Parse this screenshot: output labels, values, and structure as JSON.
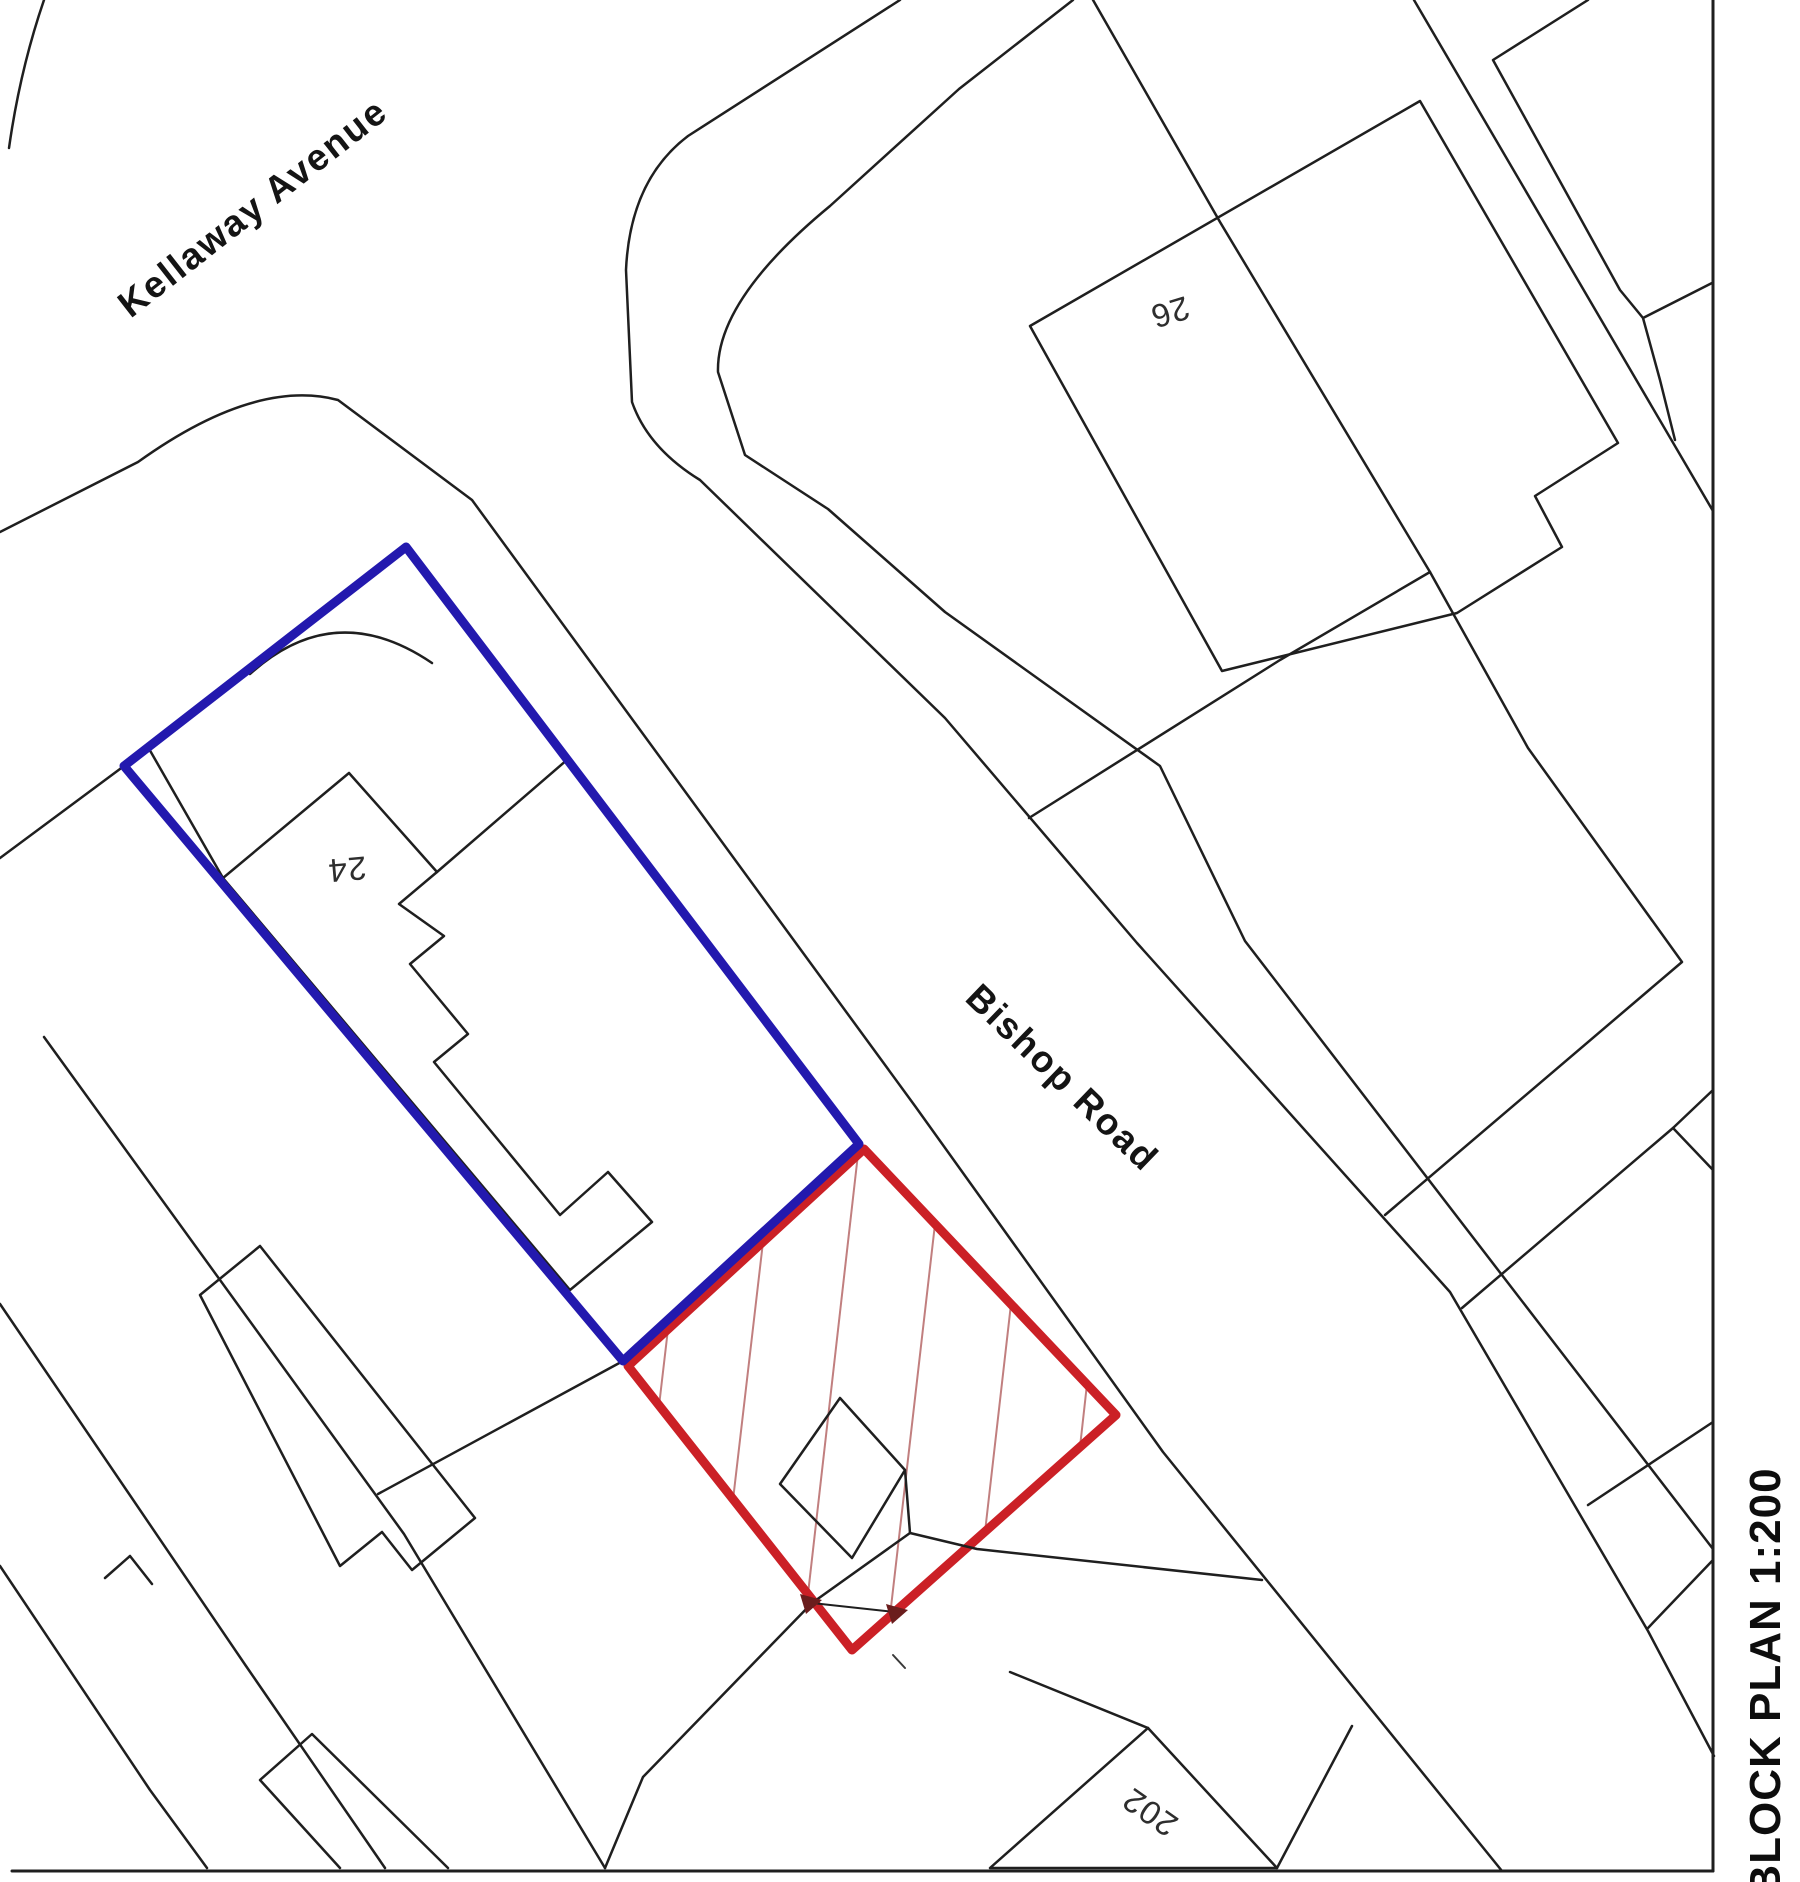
{
  "page": {
    "background": "#ffffff",
    "width": 1800,
    "height": 1882
  },
  "title": {
    "label": "BLOCK PLAN 1:200",
    "plan_type": "BLOCK PLAN",
    "scale": "1:200"
  },
  "streets": {
    "kellaway": {
      "name": "Kellaway Avenue"
    },
    "bishop": {
      "name": "Bishop Road"
    }
  },
  "plots": {
    "no26": {
      "number": "26"
    },
    "no24": {
      "number": "24"
    },
    "no202": {
      "number": "202"
    }
  },
  "legend": {
    "outlined_property_color": "#2319ae",
    "application_site_color": "#cb2026",
    "hatch_color": "#c17f7f",
    "line_color": "#1f1f1f"
  },
  "boundaries": {
    "blue_outline_vertices": "406,547 859,1144 623,1361 124,766",
    "red_site_vertices": "864,1149 1116,1415 852,1650 628,1366"
  },
  "map": {
    "paths": [
      {
        "name": "corner-arc-top-left",
        "d": "M44,0 Q20,70 9,148",
        "stroke": "#1f1f1f",
        "w": 2.5,
        "fill": "none"
      },
      {
        "name": "kerb-kellaway-bishop",
        "d": "M0,532 L138,462 Q255,378 338,400 L472,500 L915,1106 L1163,1452 L1502,1871",
        "stroke": "#1f1f1f",
        "w": 2.5,
        "fill": "none"
      },
      {
        "name": "road-ne-edge",
        "d": "M900,0 L688,136 Q630,180 626,270 L632,402 Q648,448 700,480 L945,718 L1137,943 L1450,1292 L1648,1631 L1714,1756",
        "stroke": "#1f1f1f",
        "w": 2.5,
        "fill": "none"
      },
      {
        "name": "corner-plot-inner-line",
        "d": "M1073,0 L959,89 L830,206 Q716,300 718,372 L745,455 L828,509 L945,612 L1160,766 L1245,941 L1545,1331 L1713,1549",
        "stroke": "#1f1f1f",
        "w": 2.5,
        "fill": "none"
      },
      {
        "name": "plot-boundary-line-a",
        "d": "M1093,0 L1220,222 L1430,572 L1528,748 L1682,962 L1385,1215",
        "stroke": "#1f1f1f",
        "w": 2.5,
        "fill": "none"
      },
      {
        "name": "plot-boundary-line-a-branch",
        "d": "M1430,572 L1280,660 L1029,818",
        "stroke": "#1f1f1f",
        "w": 2.5,
        "fill": "none"
      },
      {
        "name": "building-26-outline",
        "d": "M1420,101 L1030,326 L1222,671 L1457,613 L1562,547 L1535,496 L1618,443 Z",
        "stroke": "#1f1f1f",
        "w": 2.5,
        "fill": "none"
      },
      {
        "name": "plot-boundary-ne-parallel",
        "d": "M1414,0 L1713,511",
        "stroke": "#1f1f1f",
        "w": 2.5,
        "fill": "none"
      },
      {
        "name": "building-top-right-outline",
        "d": "M1588,0 L1493,60 L1620,290 L1643,318 M1643,318 L1712,283 M1643,318 L1660,380 L1675,440",
        "stroke": "#1f1f1f",
        "w": 2.5,
        "fill": "none"
      },
      {
        "name": "frame-border-right",
        "d": "M1713,0 L1713,1871",
        "stroke": "#1f1f1f",
        "w": 3,
        "fill": "none"
      },
      {
        "name": "frame-border-bottom",
        "d": "M12,1871 L1713,1871",
        "stroke": "#1f1f1f",
        "w": 3,
        "fill": "none"
      },
      {
        "name": "plot-boundary-east-1",
        "d": "M1713,1090 L1673,1128 L1462,1308",
        "stroke": "#1f1f1f",
        "w": 2.5,
        "fill": "none"
      },
      {
        "name": "plot-boundary-east-2",
        "d": "M1673,1128 L1713,1170",
        "stroke": "#1f1f1f",
        "w": 2.5,
        "fill": "none"
      },
      {
        "name": "plot-boundary-east-3",
        "d": "M1588,1505 L1713,1422",
        "stroke": "#1f1f1f",
        "w": 2.5,
        "fill": "none"
      },
      {
        "name": "plot-boundary-east-4",
        "d": "M1648,1628 L1713,1560",
        "stroke": "#1f1f1f",
        "w": 2.5,
        "fill": "none"
      },
      {
        "name": "blue-nw-edge-extension",
        "d": "M124,766 L0,858",
        "stroke": "#1f1f1f",
        "w": 2.5,
        "fill": "none"
      },
      {
        "name": "fence-sw-24",
        "d": "M148,747 L223,878",
        "stroke": "#1f1f1f",
        "w": 2.5,
        "fill": "none"
      },
      {
        "name": "fence-ne-24",
        "d": "M437,872 L568,759",
        "stroke": "#1f1f1f",
        "w": 2.5,
        "fill": "none"
      },
      {
        "name": "garden-arc-24",
        "d": "M250,674 Q335,597 432,663",
        "stroke": "#1f1f1f",
        "w": 2.5,
        "fill": "none"
      },
      {
        "name": "building-24-outline",
        "d": "M223,878 L349,773 L437,872 L399,904 L444,936 L410,964 L468,1034 L434,1062 L560,1215 L608,1172 L652,1222 L570,1290 Z",
        "stroke": "#1f1f1f",
        "w": 2.5,
        "fill": "none"
      },
      {
        "name": "plot-line-south-of-blue",
        "d": "M623,1361 L378,1494",
        "stroke": "#1f1f1f",
        "w": 2.5,
        "fill": "none"
      },
      {
        "name": "terrace-boundary-1",
        "d": "M44,1037 L404,1534 L605,1868",
        "stroke": "#1f1f1f",
        "w": 2.5,
        "fill": "none"
      },
      {
        "name": "terrace-boundary-2",
        "d": "M0,1304 L246,1666 L385,1868",
        "stroke": "#1f1f1f",
        "w": 2.5,
        "fill": "none"
      },
      {
        "name": "terrace-boundary-3",
        "d": "M0,1566 L150,1790 L207,1868",
        "stroke": "#1f1f1f",
        "w": 2.5,
        "fill": "none"
      },
      {
        "name": "terrace-building-1",
        "d": "M200,1295 L260,1246 L475,1518 L412,1570 L382,1532 L340,1566 Z",
        "stroke": "#1f1f1f",
        "w": 2.5,
        "fill": "none"
      },
      {
        "name": "terrace-step-detail",
        "d": "M105,1578 L130,1556 L152,1584",
        "stroke": "#1f1f1f",
        "w": 2.5,
        "fill": "none"
      },
      {
        "name": "terrace-building-2",
        "d": "M260,1780 L312,1734 L448,1868 M340,1868 L260,1780",
        "stroke": "#1f1f1f",
        "w": 2.5,
        "fill": "none"
      },
      {
        "name": "hatch-line-1",
        "d": "M668,1329 L659,1406",
        "stroke": "#c17f7f",
        "w": 2,
        "fill": "none"
      },
      {
        "name": "hatch-line-2",
        "d": "M763,1242 L733,1500",
        "stroke": "#c17f7f",
        "w": 2,
        "fill": "none"
      },
      {
        "name": "hatch-line-3",
        "d": "M858,1154 L808,1594",
        "stroke": "#c17f7f",
        "w": 2,
        "fill": "none"
      },
      {
        "name": "hatch-line-4",
        "d": "M935,1224 L890,1616",
        "stroke": "#c17f7f",
        "w": 2,
        "fill": "none"
      },
      {
        "name": "hatch-line-5",
        "d": "M1011,1304 L985,1532",
        "stroke": "#c17f7f",
        "w": 2,
        "fill": "none"
      },
      {
        "name": "hatch-line-6",
        "d": "M1087,1384 L1080,1447",
        "stroke": "#c17f7f",
        "w": 2,
        "fill": "none"
      },
      {
        "name": "red-site-boundary",
        "d": "M864,1149 L1116,1415 L852,1650 L628,1366 Z",
        "stroke": "#cb2026",
        "w": 9,
        "fill": "none"
      },
      {
        "name": "blue-property-boundary",
        "d": "M406,547 L859,1144 L623,1361 L124,766 Z",
        "stroke": "#2319ae",
        "w": 9,
        "fill": "none"
      },
      {
        "name": "building-in-red-site",
        "d": "M840,1398 L905,1470 L852,1558 L780,1484 Z",
        "stroke": "#1f1f1f",
        "w": 2.5,
        "fill": "none"
      },
      {
        "name": "boundary-branch-east",
        "d": "M905,1470 L910,1533 L977,1549 L1262,1580",
        "stroke": "#1f1f1f",
        "w": 2.5,
        "fill": "none"
      },
      {
        "name": "boundary-branch-southwest",
        "d": "M910,1533 L812,1603 L643,1777 L605,1868",
        "stroke": "#1f1f1f",
        "w": 2.5,
        "fill": "none"
      },
      {
        "name": "dimension-line",
        "d": "M812,1603 L895,1612",
        "stroke": "#1f1f1f",
        "w": 2,
        "fill": "none"
      },
      {
        "name": "dimension-arrow-left",
        "d": "M800,1594 L822,1600 L806,1614 Z",
        "stroke": "none",
        "w": 0,
        "fill": "#6b1d1d"
      },
      {
        "name": "dimension-arrow-right",
        "d": "M886,1604 L908,1610 L892,1624 Z",
        "stroke": "none",
        "w": 0,
        "fill": "#6b1d1d"
      },
      {
        "name": "dimension-tick",
        "d": "M893,1655 L905,1668",
        "stroke": "#3a3a3a",
        "w": 2,
        "fill": "none"
      },
      {
        "name": "building-202-outline",
        "d": "M1148,1728 L990,1868 L1277,1868 Z",
        "stroke": "#1f1f1f",
        "w": 2.5,
        "fill": "none"
      },
      {
        "name": "plot-202-left-boundary",
        "d": "M1148,1728 L1010,1672",
        "stroke": "#1f1f1f",
        "w": 2.5,
        "fill": "none"
      },
      {
        "name": "plot-202-right-boundary",
        "d": "M1277,1868 L1352,1726",
        "stroke": "#1f1f1f",
        "w": 2.5,
        "fill": "none"
      }
    ]
  }
}
